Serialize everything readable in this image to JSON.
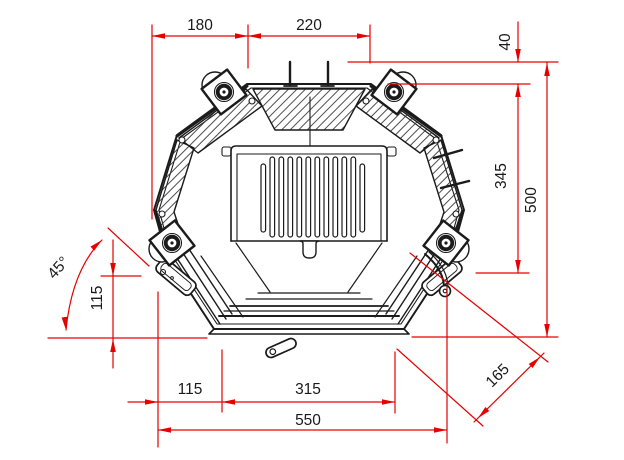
{
  "colors": {
    "dimension_line": "#e60000",
    "drawing_line": "#1b1b1b",
    "background": "#ffffff"
  },
  "dimensions": {
    "top_left_width": "180",
    "top_right_width": "220",
    "rear_offset": "40",
    "side_depth": "345",
    "total_depth": "500",
    "door_opening_angle": "45°",
    "front_height": "115",
    "bottom_left_width": "115",
    "bottom_center_width": "315",
    "bottom_total_width": "550",
    "corner_chamfer": "165"
  }
}
